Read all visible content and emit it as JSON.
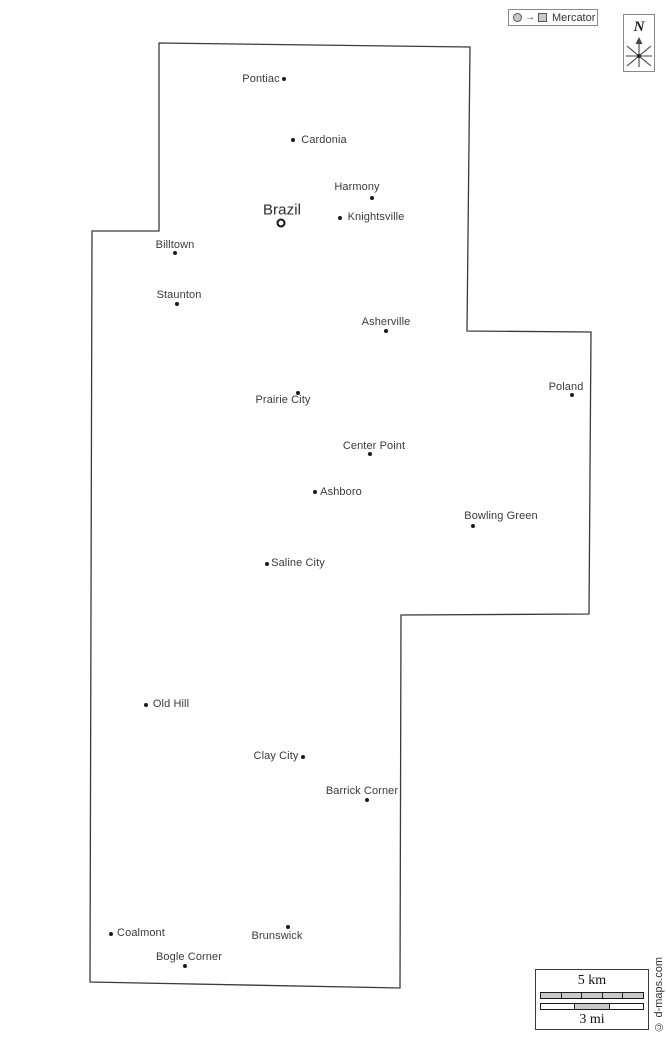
{
  "map": {
    "outline_points": "159,43 470,47 467,331 591,332 589,614 401,615 400,988 90,982 92,231 159,231",
    "outline_color": "#3a3a3a",
    "cities": [
      {
        "slug": "pontiac",
        "name": "Pontiac",
        "dot_x": 284,
        "dot_y": 79,
        "label_x": 261,
        "label_y": 79,
        "capital": false
      },
      {
        "slug": "cardonia",
        "name": "Cardonia",
        "dot_x": 293,
        "dot_y": 140,
        "label_x": 324,
        "label_y": 140,
        "capital": false
      },
      {
        "slug": "harmony",
        "name": "Harmony",
        "dot_x": 372,
        "dot_y": 198,
        "label_x": 357,
        "label_y": 187,
        "capital": false
      },
      {
        "slug": "brazil",
        "name": "Brazil",
        "dot_x": 281,
        "dot_y": 223,
        "label_x": 282,
        "label_y": 210,
        "capital": true
      },
      {
        "slug": "knightsville",
        "name": "Knightsville",
        "dot_x": 340,
        "dot_y": 218,
        "label_x": 376,
        "label_y": 217,
        "capital": false
      },
      {
        "slug": "billtown",
        "name": "Billtown",
        "dot_x": 175,
        "dot_y": 253,
        "label_x": 175,
        "label_y": 245,
        "capital": false
      },
      {
        "slug": "staunton",
        "name": "Staunton",
        "dot_x": 177,
        "dot_y": 304,
        "label_x": 179,
        "label_y": 295,
        "capital": false
      },
      {
        "slug": "asherville",
        "name": "Asherville",
        "dot_x": 386,
        "dot_y": 331,
        "label_x": 386,
        "label_y": 322,
        "capital": false
      },
      {
        "slug": "poland",
        "name": "Poland",
        "dot_x": 572,
        "dot_y": 395,
        "label_x": 566,
        "label_y": 387,
        "capital": false
      },
      {
        "slug": "prairie-city",
        "name": "Prairie City",
        "dot_x": 298,
        "dot_y": 393,
        "label_x": 283,
        "label_y": 400,
        "capital": false
      },
      {
        "slug": "center-point",
        "name": "Center Point",
        "dot_x": 370,
        "dot_y": 454,
        "label_x": 374,
        "label_y": 446,
        "capital": false
      },
      {
        "slug": "ashboro",
        "name": "Ashboro",
        "dot_x": 315,
        "dot_y": 492,
        "label_x": 341,
        "label_y": 492,
        "capital": false
      },
      {
        "slug": "bowling-green",
        "name": "Bowling Green",
        "dot_x": 473,
        "dot_y": 526,
        "label_x": 501,
        "label_y": 516,
        "capital": false
      },
      {
        "slug": "saline-city",
        "name": "Saline City",
        "dot_x": 267,
        "dot_y": 564,
        "label_x": 298,
        "label_y": 563,
        "capital": false
      },
      {
        "slug": "old-hill",
        "name": "Old Hill",
        "dot_x": 146,
        "dot_y": 705,
        "label_x": 171,
        "label_y": 704,
        "capital": false
      },
      {
        "slug": "clay-city",
        "name": "Clay City",
        "dot_x": 303,
        "dot_y": 757,
        "label_x": 276,
        "label_y": 756,
        "capital": false
      },
      {
        "slug": "barrick-corner",
        "name": "Barrick Corner",
        "dot_x": 367,
        "dot_y": 800,
        "label_x": 362,
        "label_y": 791,
        "capital": false
      },
      {
        "slug": "coalmont",
        "name": "Coalmont",
        "dot_x": 111,
        "dot_y": 934,
        "label_x": 141,
        "label_y": 933,
        "capital": false
      },
      {
        "slug": "brunswick",
        "name": "Brunswick",
        "dot_x": 288,
        "dot_y": 927,
        "label_x": 277,
        "label_y": 936,
        "capital": false
      },
      {
        "slug": "bogle-corner",
        "name": "Bogle Corner",
        "dot_x": 185,
        "dot_y": 966,
        "label_x": 189,
        "label_y": 957,
        "capital": false
      }
    ]
  },
  "projection_badge": {
    "label": "Mercator",
    "arrow": "→",
    "circle_icon": "globe-circle",
    "square_icon": "flat-square"
  },
  "compass": {
    "north_label": "N"
  },
  "scale_bar": {
    "km_label": "5 km",
    "mi_label": "3 mi",
    "km_segments": 5,
    "mi_segments": 3
  },
  "watermark": {
    "text": "© d-maps.com"
  },
  "colors": {
    "background": "#ffffff",
    "outline": "#3a3a3a",
    "label_text": "#3a3a3a",
    "marker": "#1c1c1c",
    "scale_fill": "#c9c9c9"
  }
}
